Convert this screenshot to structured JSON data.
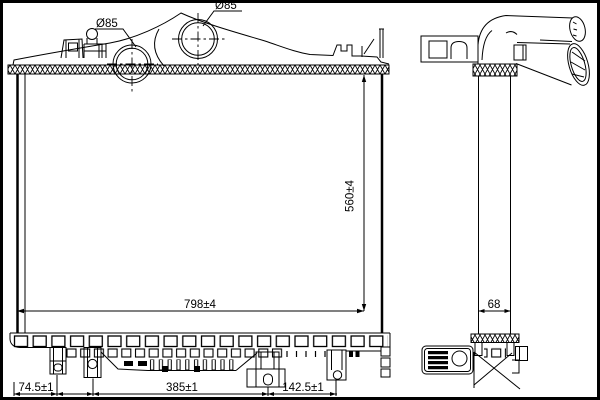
{
  "colors": {
    "line": "#000000",
    "background": "#ffffff"
  },
  "labels": {
    "port_front": "Ø85",
    "port_rear": "Ø85",
    "height": "560±4",
    "width": "798±4",
    "depth": "68",
    "feet_left": "74.5±1",
    "feet_middle": "385±1",
    "feet_right": "142.5±1"
  }
}
